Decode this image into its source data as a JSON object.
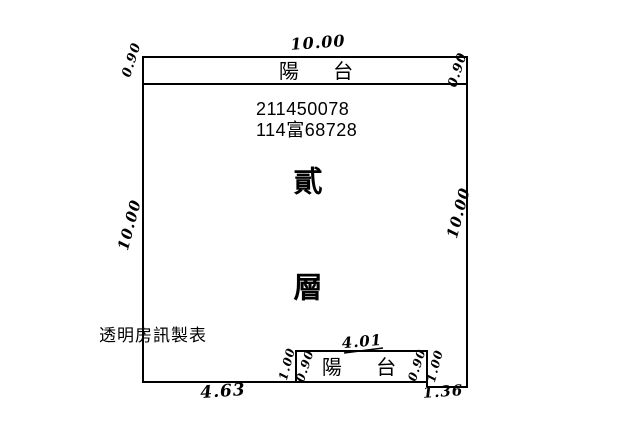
{
  "plan": {
    "top": {
      "width_dim": "10.00",
      "left_dim": "0.90",
      "right_dim": "0.90",
      "balcony_label": "陽 台"
    },
    "center": {
      "id1": "211450078",
      "id2": "114富68728",
      "floor_upper": "貳",
      "floor_lower": "層"
    },
    "sides": {
      "left_dim": "10.00",
      "right_dim": "10.00"
    },
    "bottom_balcony": {
      "label": "陽 台",
      "width_dim": "4.01",
      "left_outer_dim": "1.00",
      "left_inner_dim": "0.90",
      "right_inner_dim": "0.90",
      "right_outer_dim": "1.00"
    },
    "bottom": {
      "left_dim": "4.63",
      "right_dim": "1.36"
    },
    "maker_label": "透明房訊製表"
  },
  "colors": {
    "line": "#000000",
    "background": "#ffffff"
  }
}
